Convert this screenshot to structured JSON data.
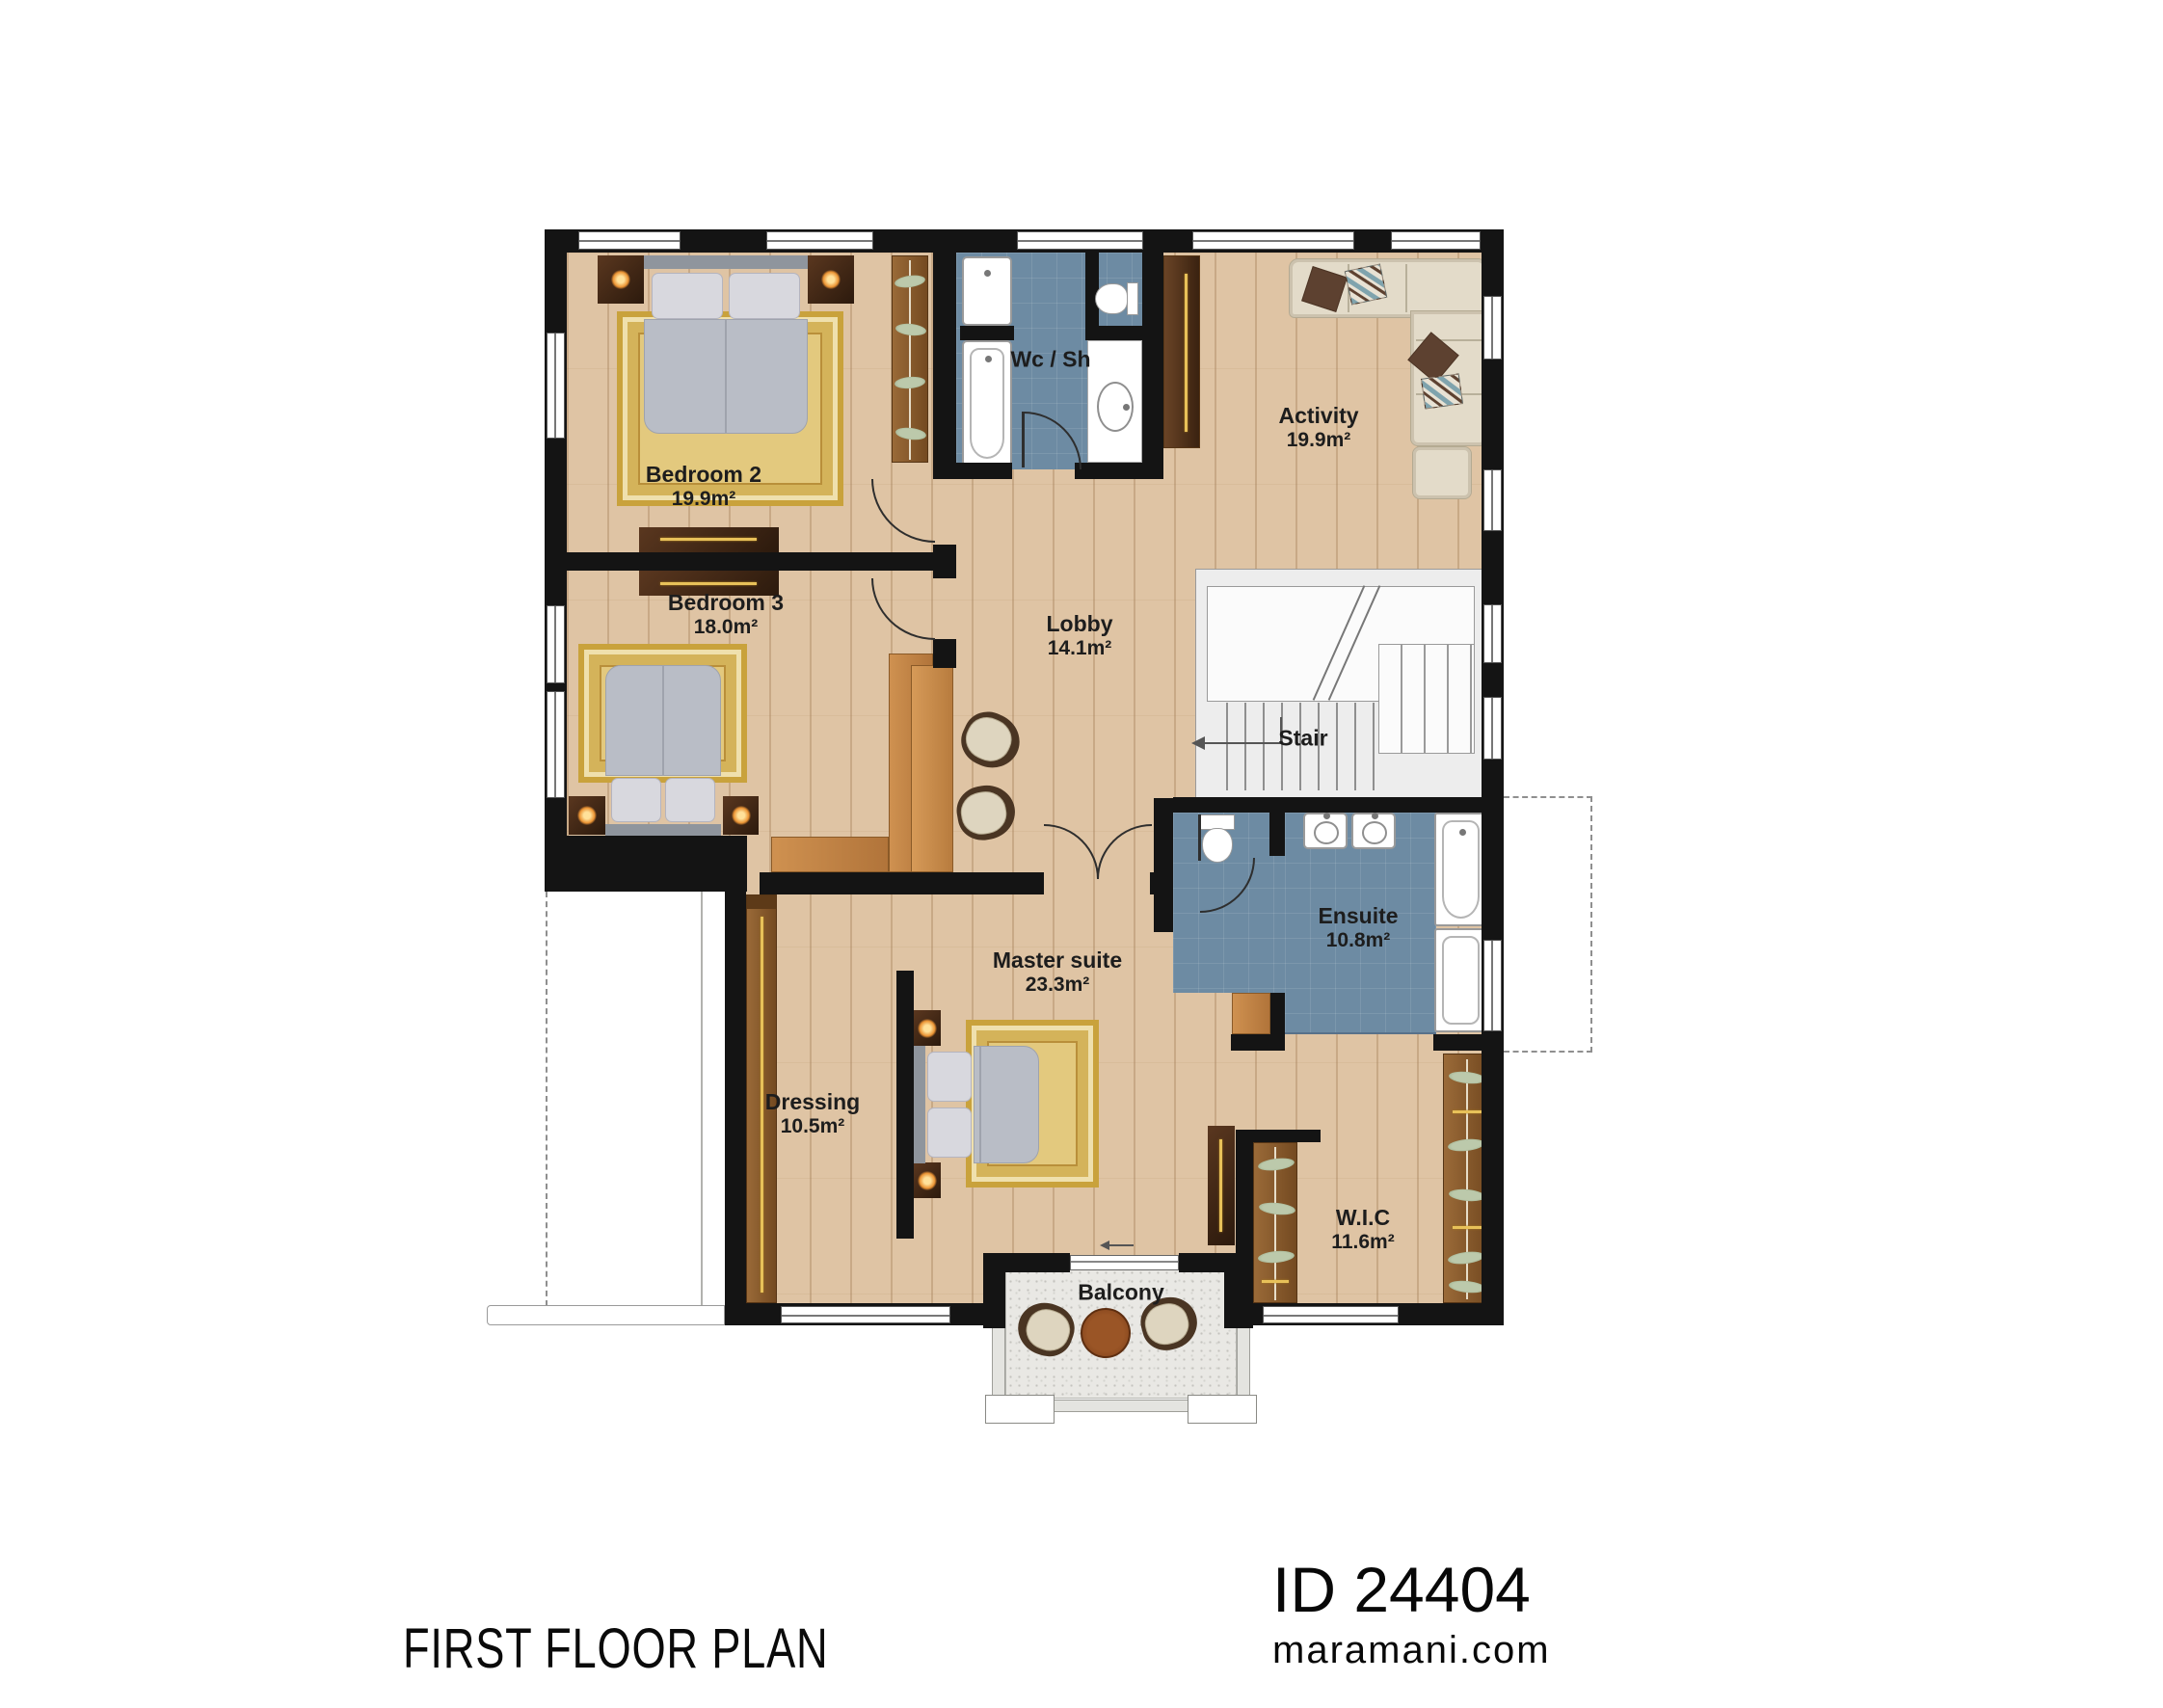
{
  "plan": {
    "title": "FIRST FLOOR PLAN",
    "brand": {
      "id": "ID 24404",
      "site": "maramani.com"
    },
    "rooms": [
      {
        "key": "bedroom2",
        "name": "Bedroom 2",
        "area": "19.9m²"
      },
      {
        "key": "bedroom3",
        "name": "Bedroom 3",
        "area": "18.0m²"
      },
      {
        "key": "wcsh",
        "name": "Wc / Sh",
        "area": ""
      },
      {
        "key": "activity",
        "name": "Activity",
        "area": "19.9m²"
      },
      {
        "key": "lobby",
        "name": "Lobby",
        "area": "14.1m²"
      },
      {
        "key": "stair",
        "name": "Stair",
        "area": ""
      },
      {
        "key": "ensuite",
        "name": "Ensuite",
        "area": "10.8m²"
      },
      {
        "key": "master",
        "name": "Master suite",
        "area": "23.3m²"
      },
      {
        "key": "dressing",
        "name": "Dressing",
        "area": "10.5m²"
      },
      {
        "key": "wic",
        "name": "W.I.C",
        "area": "11.6m²"
      },
      {
        "key": "balcony",
        "name": "Balcony",
        "area": ""
      }
    ],
    "colors": {
      "wall": "#141414",
      "wood": "#dfc4a4",
      "bath_tile": "#6d8ba3",
      "stair": "#ededed",
      "rug": "#e3c97e",
      "oak_cabinet": "#c08144",
      "dark_cabinet": "#3d2313",
      "wardrobe_brown": "#8a5a2e",
      "sofa": "#e3dbc9",
      "balcony_floor": "#e9e8e4",
      "lamp_glow": "#eb9434"
    }
  }
}
